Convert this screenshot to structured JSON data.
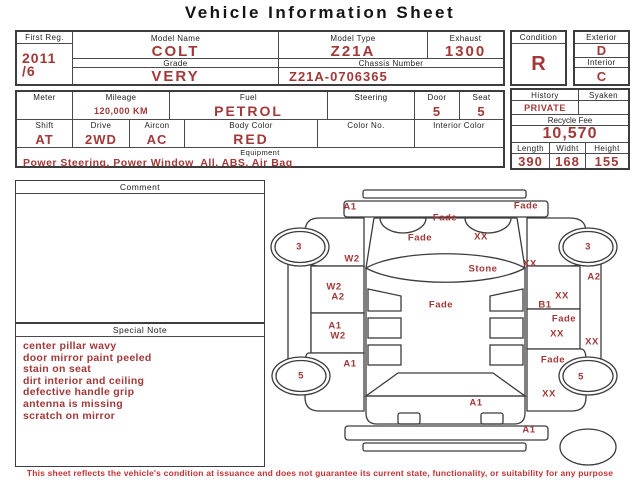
{
  "header": {
    "title": "Vehicle Information Sheet"
  },
  "colors": {
    "value_red": "#a23838",
    "disclaimer_red": "#c43232",
    "line_gray": "#4a4a4a"
  },
  "summary": {
    "first_reg_label": "First Reg.",
    "first_reg_year": "2011",
    "first_reg_month": "/6",
    "model_name_label": "Model Name",
    "model_name": "COLT",
    "grade_label": "Grade",
    "grade": "VERY",
    "model_type_label": "Model Type",
    "model_type": "Z21A",
    "exhaust_label": "Exhaust",
    "exhaust": "1300",
    "chassis_label": "Chassis Number",
    "chassis": "Z21A-0706365"
  },
  "condition": {
    "condition_label": "Condition",
    "condition": "R",
    "exterior_label": "Exterior",
    "exterior": "D",
    "interior_label": "Interior",
    "interior": "C"
  },
  "details": {
    "meter_label": "Meter",
    "meter": "",
    "mileage_label": "Mileage",
    "mileage": "120,000 KM",
    "fuel_label": "Fuel",
    "fuel": "PETROL",
    "steering_label": "Steering",
    "steering": "",
    "door_label": "Door",
    "door": "5",
    "seat_label": "Seat",
    "seat": "5",
    "shift_label": "Shift",
    "shift": "AT",
    "drive_label": "Drive",
    "drive": "2WD",
    "aircon_label": "Aircon",
    "aircon": "AC",
    "body_color_label": "Body Color",
    "body_color": "RED",
    "color_no_label": "Color No.",
    "color_no": "",
    "interior_color_label": "Interior Color",
    "interior_color": "",
    "equipment_label": "Equipment",
    "equipment": "Power Steering, Power Window  All, ABS, Air Bag"
  },
  "history": {
    "history_label": "History",
    "history": "PRIVATE",
    "syaken_label": "Syaken",
    "syaken": "",
    "recycle_label": "Recycle Fee",
    "recycle_fee": "10,570",
    "length_label": "Length",
    "length": "390",
    "widht_label": "Widht",
    "widht": "168",
    "height_label": "Height",
    "height": "155"
  },
  "comment": {
    "label": "Comment",
    "text": ""
  },
  "special_note": {
    "label": "Special Note",
    "lines": [
      "center pillar wavy",
      "door mirror paint peeled",
      "stain on seat",
      "dirt interior and ceiling",
      "defective handle grip",
      "antenna is missing",
      "scratch on mirror"
    ]
  },
  "diagram": {
    "marks": [
      {
        "name": "front-bumper-left",
        "code": "A1",
        "x": 82,
        "y": 21
      },
      {
        "name": "front-bumper-right",
        "code": "Fade",
        "x": 258,
        "y": 20
      },
      {
        "name": "hood-front-center",
        "code": "Fade",
        "x": 177,
        "y": 32
      },
      {
        "name": "hood-left",
        "code": "Fade",
        "x": 152,
        "y": 52
      },
      {
        "name": "hood-right",
        "code": "XX",
        "x": 213,
        "y": 51
      },
      {
        "name": "left-a-pillar",
        "code": "W2",
        "x": 84,
        "y": 73
      },
      {
        "name": "right-a-pillar",
        "code": "XX",
        "x": 262,
        "y": 78
      },
      {
        "name": "windshield",
        "code": "Stone",
        "x": 215,
        "y": 83
      },
      {
        "name": "left-front-wheel",
        "code": "3",
        "x": 31,
        "y": 61
      },
      {
        "name": "right-front-wheel",
        "code": "3",
        "x": 320,
        "y": 61
      },
      {
        "name": "right-front-fender",
        "code": "A2",
        "x": 326,
        "y": 91
      },
      {
        "name": "left-front-door-1",
        "code": "W2",
        "x": 66,
        "y": 101
      },
      {
        "name": "left-front-door-2",
        "code": "A2",
        "x": 70,
        "y": 111
      },
      {
        "name": "right-front-door-1",
        "code": "XX",
        "x": 294,
        "y": 110
      },
      {
        "name": "right-front-door-2",
        "code": "B1",
        "x": 277,
        "y": 119
      },
      {
        "name": "roof",
        "code": "Fade",
        "x": 173,
        "y": 119
      },
      {
        "name": "right-rear-door-1",
        "code": "Fade",
        "x": 296,
        "y": 133
      },
      {
        "name": "left-rear-door-1",
        "code": "A1",
        "x": 67,
        "y": 140
      },
      {
        "name": "left-rear-door-2",
        "code": "W2",
        "x": 70,
        "y": 150
      },
      {
        "name": "right-rear-door-2",
        "code": "XX",
        "x": 289,
        "y": 148
      },
      {
        "name": "right-sill",
        "code": "XX",
        "x": 324,
        "y": 156
      },
      {
        "name": "right-rear-fender-1",
        "code": "Fade",
        "x": 285,
        "y": 174
      },
      {
        "name": "left-rear-fender",
        "code": "A1",
        "x": 82,
        "y": 178
      },
      {
        "name": "left-rear-wheel",
        "code": "5",
        "x": 33,
        "y": 190
      },
      {
        "name": "right-rear-wheel",
        "code": "5",
        "x": 313,
        "y": 191
      },
      {
        "name": "right-rear-fender-2",
        "code": "XX",
        "x": 281,
        "y": 208
      },
      {
        "name": "tailgate",
        "code": "A1",
        "x": 208,
        "y": 217
      },
      {
        "name": "rear-bumper-right",
        "code": "A1",
        "x": 261,
        "y": 244
      }
    ]
  },
  "footer": {
    "disclaimer": "This sheet reflects the vehicle's condition at issuance and does not guarantee its current state, functionality, or suitability for any purpose"
  }
}
